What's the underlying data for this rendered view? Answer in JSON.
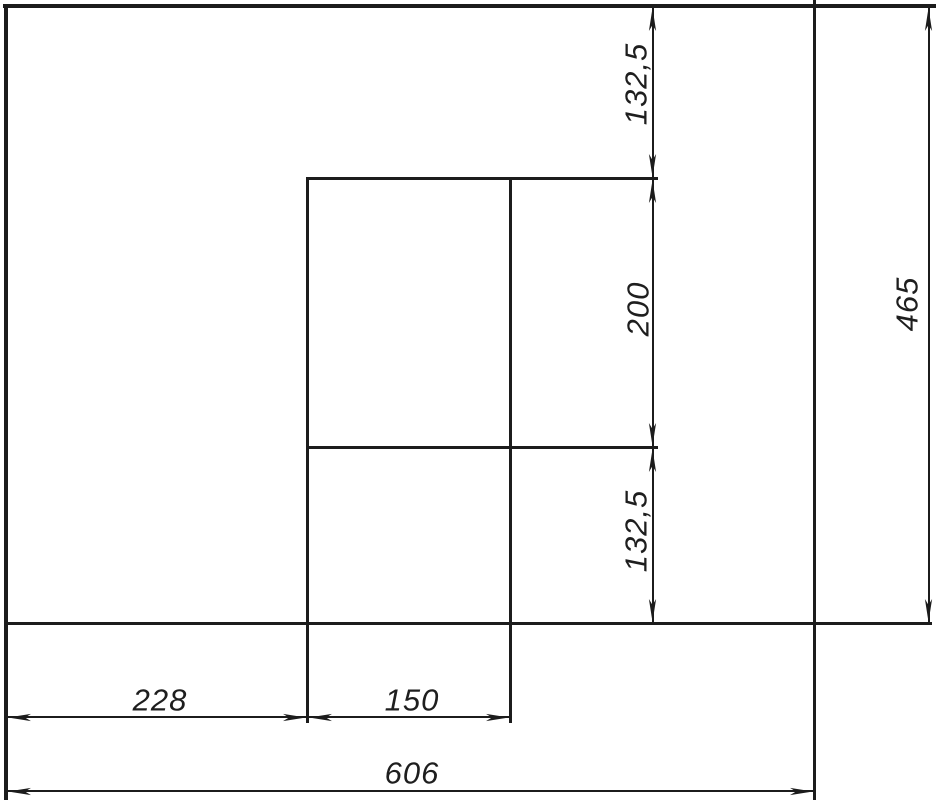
{
  "drawing": {
    "kind": "technical-dimension-drawing",
    "dims": {
      "top_segment": "132,5",
      "middle_segment": "200",
      "bottom_segment": "132,5",
      "total_height": "465",
      "left_segment": "228",
      "inner_width": "150",
      "total_width": "606"
    }
  },
  "colors": {
    "line": "#1c1c1c",
    "background": "#ffffff",
    "text": "#1e1e1e"
  }
}
